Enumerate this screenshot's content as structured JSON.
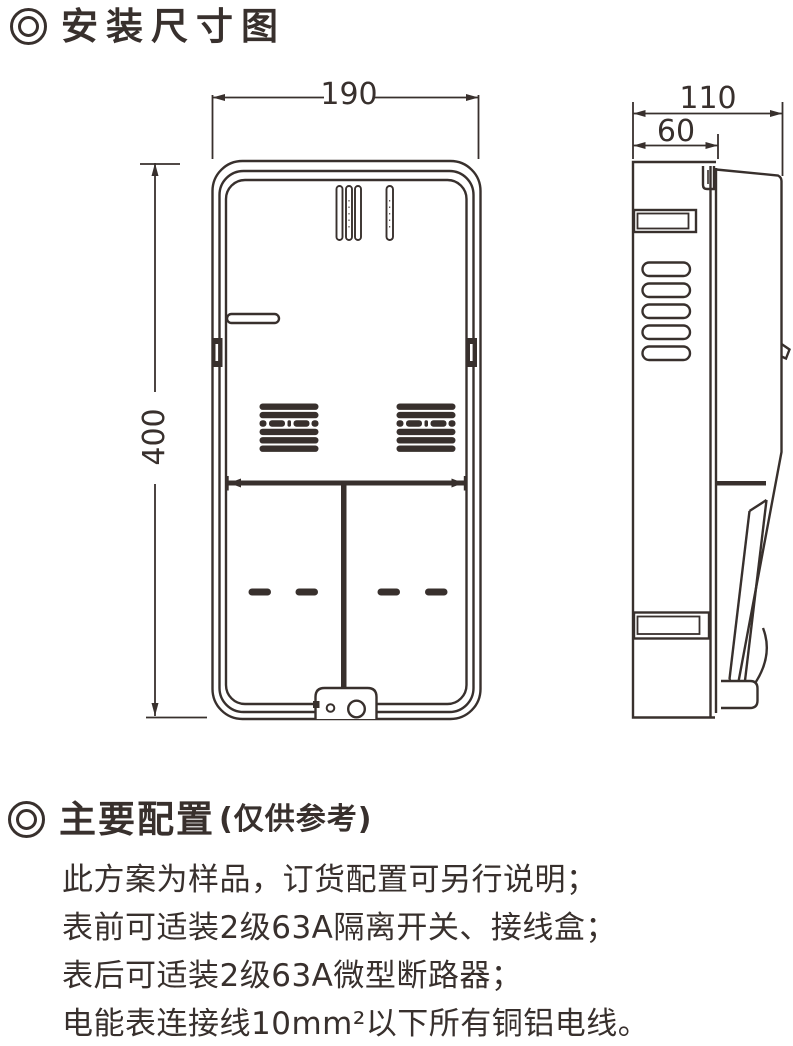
{
  "colors": {
    "ink": "#38302d",
    "bg": "#ffffff"
  },
  "install": {
    "heading": "安装尺寸图"
  },
  "dims": {
    "front_width": "190",
    "front_height": "400",
    "side_total_depth": "110",
    "side_base_depth": "60"
  },
  "config": {
    "heading": "主要配置",
    "note": "(仅供参考)",
    "lines": [
      "此方案为样品，订货配置可另行说明；",
      "表前可适装2级63A隔离开关、接线盒；",
      "表后可适装2级63A微型断路器；",
      "电能表连接线10mm²以下所有铜铝电线。"
    ]
  }
}
